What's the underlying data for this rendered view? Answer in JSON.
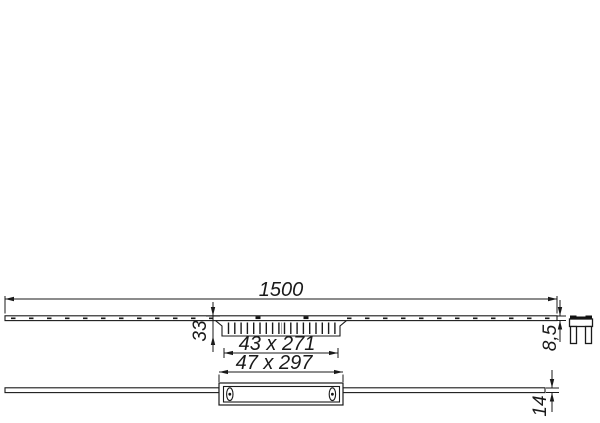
{
  "drawing": {
    "type": "technical-dimension-drawing",
    "views": {
      "top_view": "channel-plan-view",
      "bottom_view": "channel-side-view"
    },
    "dims": {
      "total_length": "1500",
      "insert_depth": "33",
      "grate_cutout": "43 x 271",
      "frame_outer": "47 x 297",
      "profile_height": "8,5",
      "body_height": "14"
    },
    "icons": {
      "right_detail": "mounting-clip-icon"
    },
    "colors": {
      "line": "#1a1a1a",
      "background": "#ffffff"
    }
  }
}
